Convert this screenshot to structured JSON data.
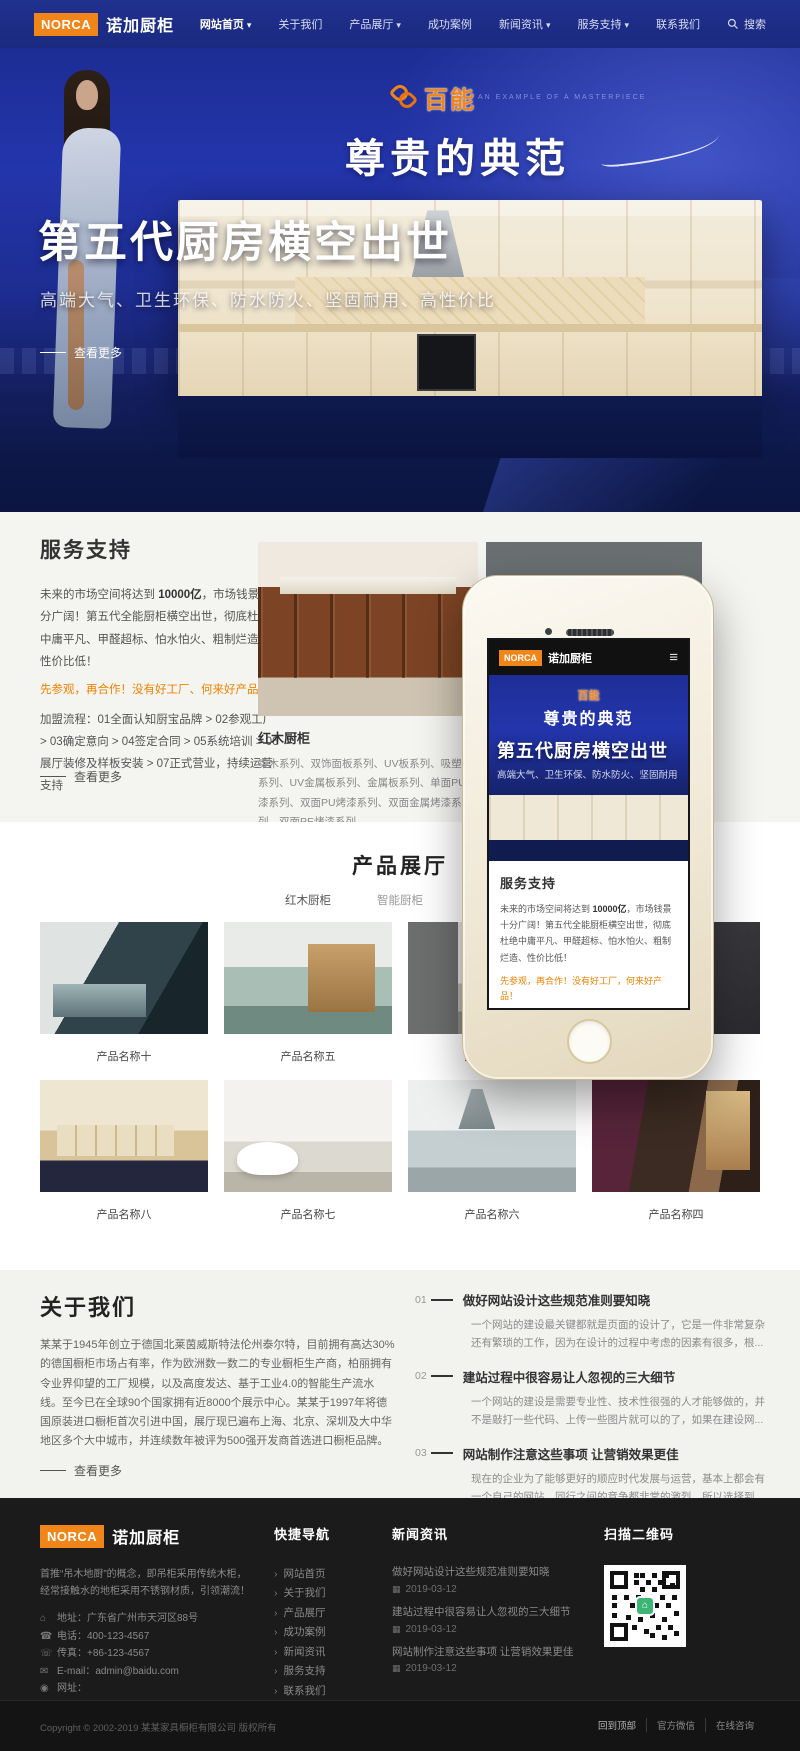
{
  "brand": {
    "logo_text": "NORCA",
    "name": "诺加厨柜",
    "accent_color": "#f08519",
    "navbar_color": "#1c2c86"
  },
  "navbar": {
    "items": [
      {
        "label": "网站首页",
        "has_caret": true,
        "active": true
      },
      {
        "label": "关于我们",
        "has_caret": false
      },
      {
        "label": "产品展厅",
        "has_caret": true
      },
      {
        "label": "成功案例",
        "has_caret": false
      },
      {
        "label": "新闻资讯",
        "has_caret": true
      },
      {
        "label": "服务支持",
        "has_caret": true
      },
      {
        "label": "联系我们",
        "has_caret": false
      }
    ],
    "search_label": "搜索"
  },
  "hero": {
    "baineng_logo": "百能",
    "baineng_tagline": "AN EXAMPLE OF A MASTERPIECE",
    "slogan": "尊贵的典范",
    "divider_note": "介绍精辟创意于心的典典",
    "private_cn": "私人典藏",
    "private_en": "PRIVATE",
    "title": "第五代厨房横空出世",
    "subtitle": "高端大气、卫生环保、防水防火、坚固耐用、高性价比",
    "more_link": "查看更多"
  },
  "services": {
    "title": "服务支持",
    "paragraph_pre": "未来的市场空间将达到 ",
    "paragraph_strong": "10000亿",
    "paragraph_post": "，市场钱景十分广阔！第五代全能厨柜横空出世，彻底杜绝中庸平凡、甲醛超标、怕水怕火、粗制烂造、性价比低！",
    "highlight": "先参观，再合作！没有好工厂、何来好产品！",
    "process": "加盟流程：01全面认知厨宝品牌 > 02参观工厂 > 03确定意向 > 04签定合同 > 05系统培训 > 06展厅装修及样板安装 > 07正式营业，持续运营支持",
    "more_link": "查看更多",
    "carousel_title": "红木厨柜",
    "carousel_desc": "实木系列、双饰面板系列、UV板系列、吸塑板系列、UV金属板系列、金属板系列、单面PU烤漆系列、双面PU烤漆系列、双面金属烤漆系列、双面PE烤漆系列..."
  },
  "products": {
    "title": "产品展厅",
    "tabs": [
      "红木厨柜",
      "智能厨柜",
      "其他厨柜"
    ],
    "items": [
      {
        "name": "产品名称十"
      },
      {
        "name": "产品名称五"
      },
      {
        "name": "产品名称一"
      },
      {
        "name": ""
      },
      {
        "name": "产品名称八"
      },
      {
        "name": "产品名称七"
      },
      {
        "name": "产品名称六"
      },
      {
        "name": "产品名称四"
      }
    ]
  },
  "about": {
    "title": "关于我们",
    "paragraph": "某某于1945年创立于德国北莱茵威斯特法伦州泰尔特，目前拥有高达30%的德国橱柜市场占有率，作为欧洲数一数二的专业橱柜生产商，柏丽拥有令业界仰望的工厂规模，以及高度发达、基于工业4.0的智能生产流水线。至今已在全球90个国家拥有近8000个展示中心。某某于1997年将德国原装进口橱柜首次引进中国，展厅现已遍布上海、北京、深圳及大中华地区多个大中城市，并连续数年被评为500强开发商首选进口橱柜品牌。2016年某某迈入大家居时代，成为首个进军整厨定制市场的全进口品牌。公司自2001年成立至今，历经18年发展，先后引进德国豪迈全系列数控自动化机器设备、意大比亚斯加工中心，使雅丽家...",
    "more_link": "查看更多",
    "news": [
      {
        "num": "01",
        "title": "做好网站设计这些规范准则要知晓",
        "desc": "一个网站的建设最关键都就是页面的设计了，它是一件非常复杂还有繁琐的工作，因为在设计的过程中考虑的因素有很多，根..."
      },
      {
        "num": "02",
        "title": "建站过程中很容易让人忽视的三大细节",
        "desc": "一个网站的建设是需要专业性、技术性很强的人才能够做的，并不是敲打一些代码、上传一些图片就可以的了，如果在建设网..."
      },
      {
        "num": "03",
        "title": "网站制作注意这些事项 让营销效果更佳",
        "desc": "现在的企业为了能够更好的顺应时代发展与运营，基本上都会有一个自己的网站。同行之间的竞争都非常的激烈，所以选择到..."
      }
    ]
  },
  "footer": {
    "desc": "首推“吊木地厨”的概念，即吊柜采用传统木柜，经常接触水的地柜采用不锈钢材质，引领潮流！",
    "contact": {
      "address": "地址：广东省广州市天河区88号",
      "phone": "电话：400-123-4567",
      "fax": "传真：+86-123-4567",
      "email": "E-mail：admin@baidu.com",
      "website": "网址："
    },
    "quick_nav": {
      "title": "快捷导航",
      "items": [
        "网站首页",
        "关于我们",
        "产品展厅",
        "成功案例",
        "新闻资讯",
        "服务支持",
        "联系我们"
      ]
    },
    "news": {
      "title": "新闻资讯",
      "items": [
        {
          "title": "做好网站设计这些规范准则要知晓",
          "date": "2019-03-12"
        },
        {
          "title": "建站过程中很容易让人忽视的三大细节",
          "date": "2019-03-12"
        },
        {
          "title": "网站制作注意这些事项 让营销效果更佳",
          "date": "2019-03-12"
        }
      ]
    },
    "qr_title": "扫描二维码",
    "copyright": "Copyright © 2002-2019 某某家具橱柜有限公司 版权所有",
    "links": [
      "回到顶部",
      "官方微信",
      "在线咨询"
    ]
  },
  "phone": {
    "header_brand": "NORCA",
    "header_name": "诺加厨柜",
    "banner_logo": "百能",
    "banner_slogan": "尊贵的典范",
    "banner_title": "第五代厨房横空出世",
    "banner_subtitle": "高端大气、卫生环保、防水防火、坚固耐用",
    "services_title": "服务支持",
    "services_pre": "未来的市场空间将达到 ",
    "services_strong": "10000亿",
    "services_post": "，市场钱景十分广阔！第五代全能厨柜横空出世，彻底杜绝中庸平凡、甲醛超标、怕水怕火、粗制烂造、性价比低！",
    "services_highlight": "先参观，再合作！没有好工厂，何来好产品！"
  }
}
